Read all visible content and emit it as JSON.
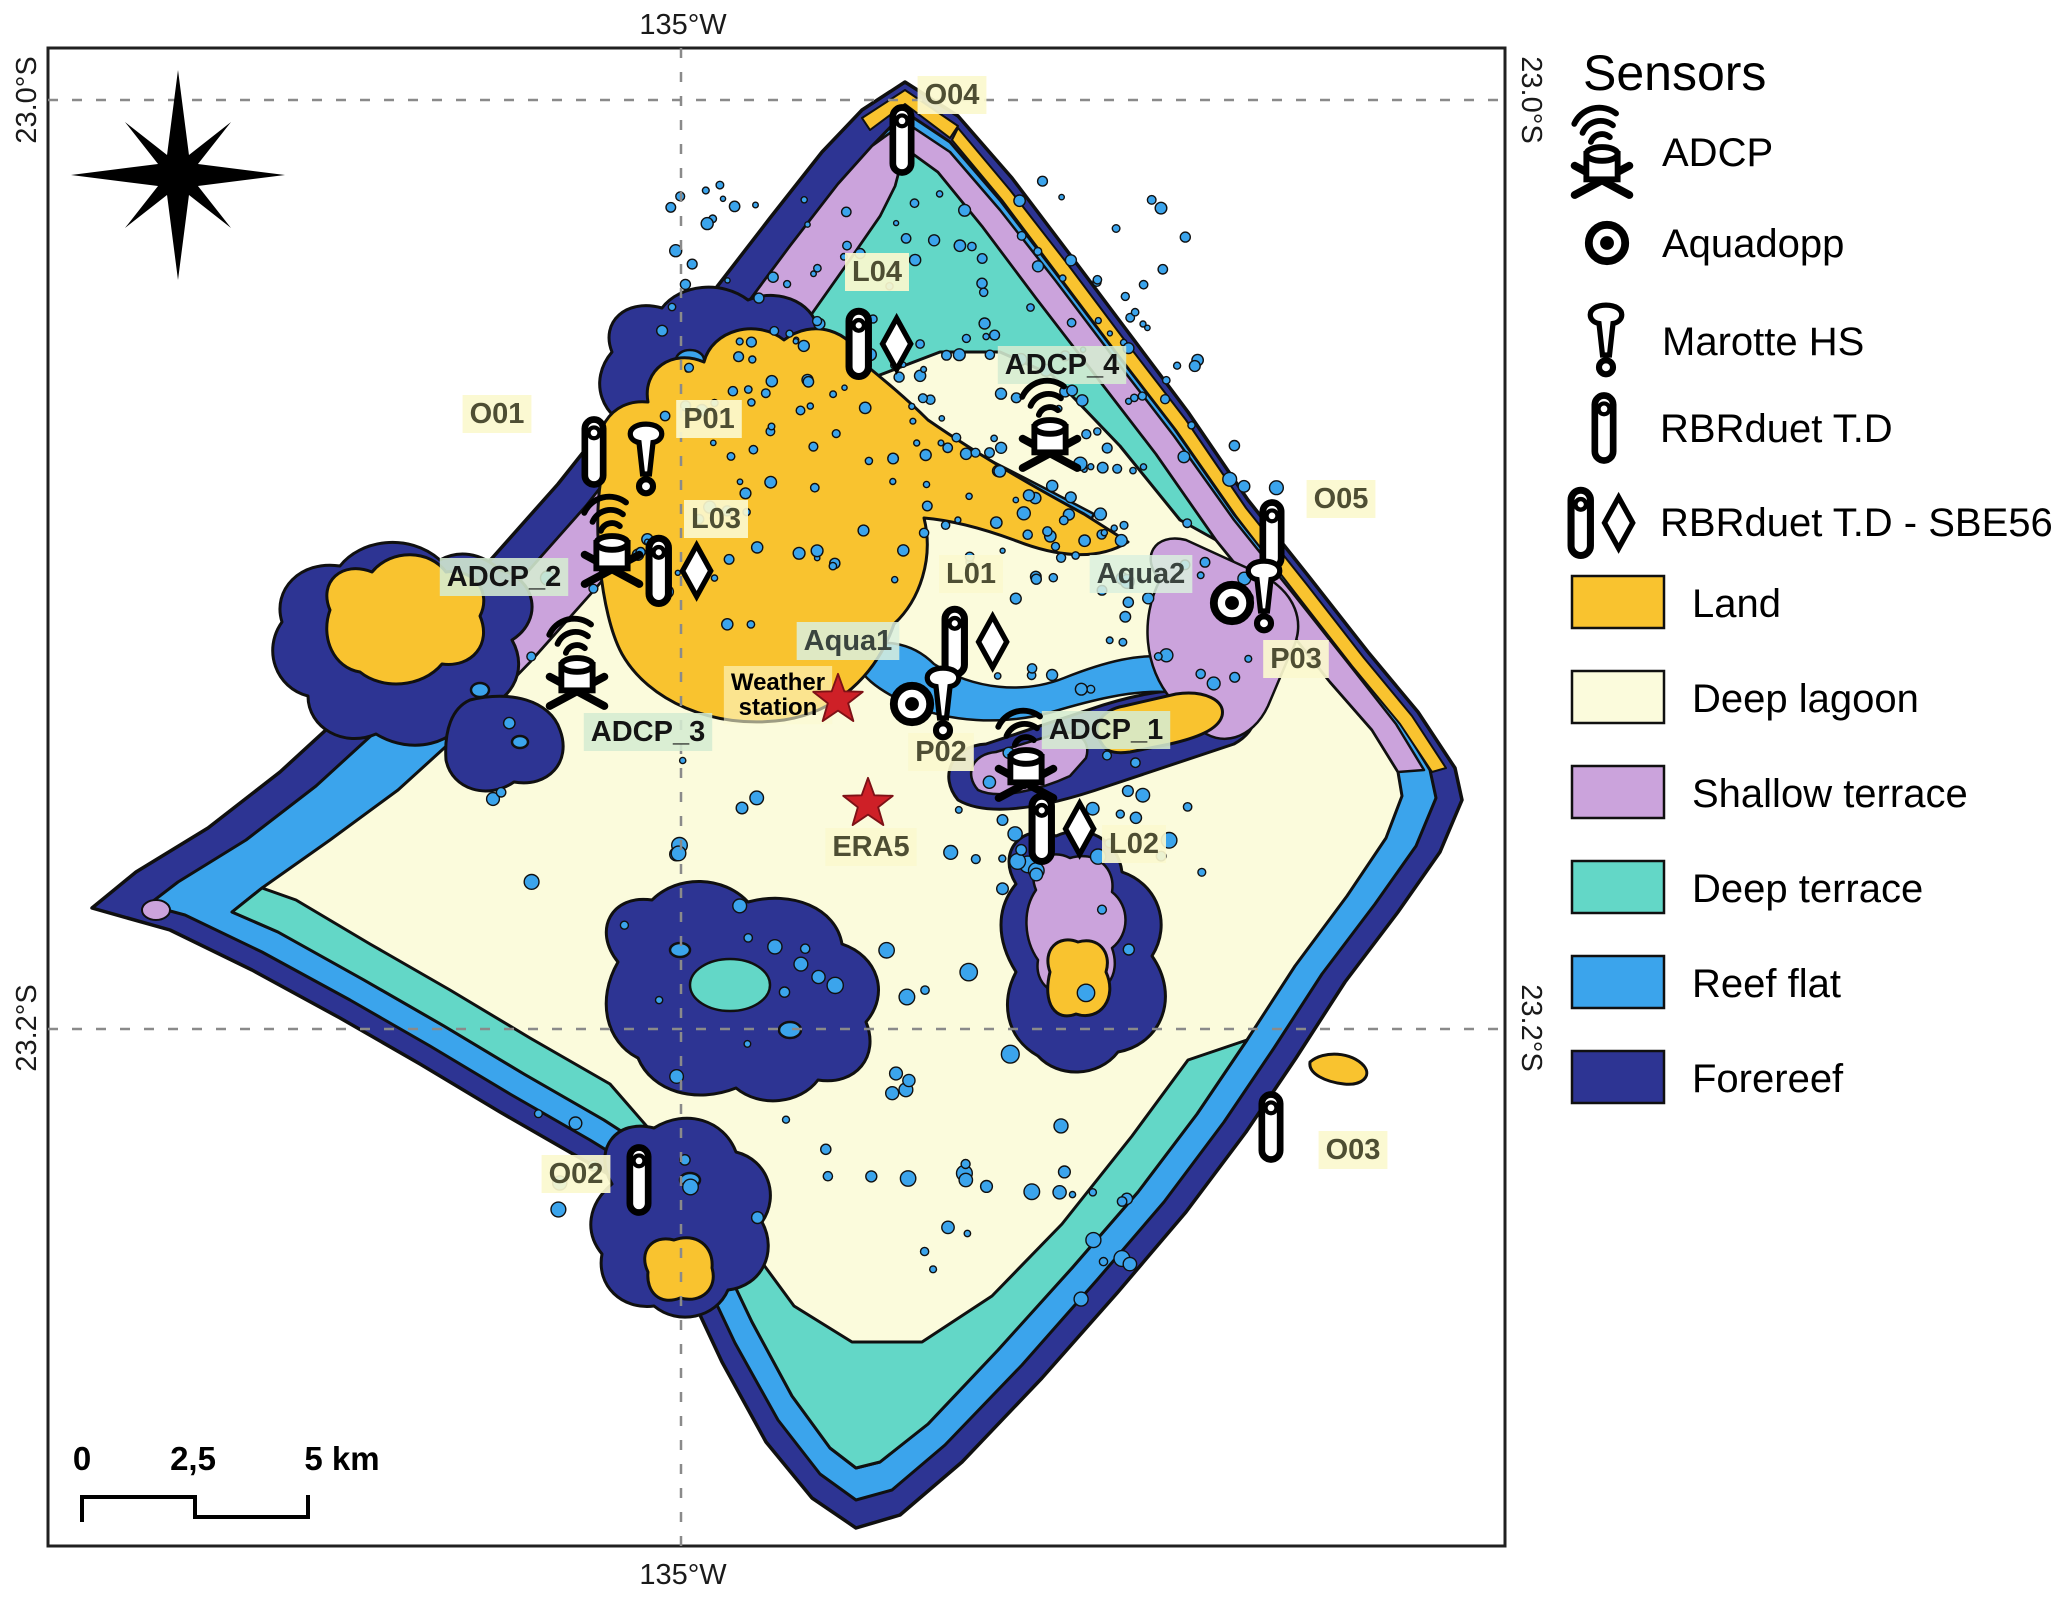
{
  "figure": {
    "axis": {
      "top": "135°W",
      "bottom": "135°W",
      "left_top": "23.0°S",
      "left_bottom": "23.2°S",
      "right_top": "23.0°S",
      "right_bottom": "23.2°S"
    },
    "scale_bar": {
      "ticks": [
        "0",
        "2,5",
        "5 km"
      ]
    }
  },
  "colors": {
    "land": "#F9C32F",
    "deep_lagoon": "#FBFBDC",
    "shallow_terrace": "#CBA3DC",
    "deep_terrace": "#63D7C7",
    "reef_flat": "#3BA4EC",
    "forereef": "#2D3493",
    "outline": "#101010",
    "grid": "#8a8a8a",
    "frame": "#202020",
    "star": "#CE2027"
  },
  "legend": {
    "title": "Sensors",
    "sensors": [
      {
        "icon": "adcp-icon",
        "label": "ADCP"
      },
      {
        "icon": "aquadopp-icon",
        "label": "Aquadopp"
      },
      {
        "icon": "marotte-icon",
        "label": "Marotte HS"
      },
      {
        "icon": "rbr-icon",
        "label": "RBRduet T.D"
      },
      {
        "icon": "rbrsbe-icon",
        "label": "RBRduet T.D - SBE56"
      }
    ],
    "zones": [
      {
        "key": "land",
        "label": "Land"
      },
      {
        "key": "deep_lagoon",
        "label": "Deep lagoon"
      },
      {
        "key": "shallow_terrace",
        "label": "Shallow terrace"
      },
      {
        "key": "deep_terrace",
        "label": "Deep terrace"
      },
      {
        "key": "reef_flat",
        "label": "Reef flat"
      },
      {
        "key": "forereef",
        "label": "Forereef"
      }
    ]
  },
  "map": {
    "label_styles": {
      "yellow": {
        "bg": "rgba(251,249,206,0.92)",
        "fg": "#4E4E33",
        "size": 29
      },
      "green": {
        "bg": "rgba(213,236,210,0.88)",
        "fg": "#141414",
        "size": 29
      },
      "aqua": {
        "bg": "rgba(218,240,222,0.85)",
        "fg": "#3A443E",
        "size": 29
      },
      "weather": {
        "bg": "rgba(252,250,208,0.60)",
        "fg": "#000000",
        "size": 24
      }
    },
    "stations": [
      {
        "id": "O04",
        "label": "O04",
        "lx": 952,
        "ly": 104,
        "style": "yellow",
        "icons": [
          {
            "t": "rbr",
            "x": 902,
            "y": 140
          }
        ]
      },
      {
        "id": "L04",
        "label": "L04",
        "lx": 877,
        "ly": 281,
        "style": "yellow",
        "icons": [
          {
            "t": "rbrsbe",
            "x": 872,
            "y": 343
          }
        ]
      },
      {
        "id": "ADCP_4",
        "label": "ADCP_4",
        "lx": 1062,
        "ly": 374,
        "style": "green",
        "icons": [
          {
            "t": "adcp",
            "x": 1050,
            "y": 442
          }
        ]
      },
      {
        "id": "O01",
        "label": "O01",
        "lx": 497,
        "ly": 423,
        "style": "yellow",
        "icons": [
          {
            "t": "rbr",
            "x": 594,
            "y": 452
          },
          {
            "t": "marotte",
            "x": 646,
            "y": 462
          }
        ]
      },
      {
        "id": "P01",
        "label": "P01",
        "lx": 709,
        "ly": 428,
        "style": "yellow",
        "icons": []
      },
      {
        "id": "L03",
        "label": "L03",
        "lx": 716,
        "ly": 528,
        "style": "yellow",
        "icons": [
          {
            "t": "rbrsbe",
            "x": 672,
            "y": 570
          }
        ]
      },
      {
        "id": "ADCP_2",
        "label": "ADCP_2",
        "lx": 504,
        "ly": 586,
        "style": "green",
        "icons": [
          {
            "t": "adcp",
            "x": 612,
            "y": 558
          }
        ]
      },
      {
        "id": "O05",
        "label": "O05",
        "lx": 1341,
        "ly": 508,
        "style": "yellow",
        "icons": [
          {
            "t": "rbr",
            "x": 1272,
            "y": 535
          }
        ]
      },
      {
        "id": "Aqua2",
        "label": "Aqua2",
        "lx": 1141,
        "ly": 583,
        "style": "aqua",
        "icons": [
          {
            "t": "aquadopp",
            "x": 1232,
            "y": 603
          },
          {
            "t": "marotte",
            "x": 1264,
            "y": 599
          }
        ]
      },
      {
        "id": "P03",
        "label": "P03",
        "lx": 1296,
        "ly": 668,
        "style": "yellow",
        "icons": []
      },
      {
        "id": "L01",
        "label": "L01",
        "lx": 971,
        "ly": 583,
        "style": "yellow",
        "icons": [
          {
            "t": "rbrsbe",
            "x": 968,
            "y": 641
          }
        ]
      },
      {
        "id": "Aqua1",
        "label": "Aqua1",
        "lx": 848,
        "ly": 650,
        "style": "aqua",
        "icons": []
      },
      {
        "id": "Weather",
        "label": "Weather\nstation",
        "lx": 778,
        "ly": 690,
        "style": "weather",
        "icons": [
          {
            "t": "star",
            "x": 838,
            "y": 699
          }
        ]
      },
      {
        "id": "ADCP_3",
        "label": "ADCP_3",
        "lx": 648,
        "ly": 741,
        "style": "green",
        "icons": [
          {
            "t": "adcp",
            "x": 577,
            "y": 680
          }
        ]
      },
      {
        "id": "P02",
        "label": "P02",
        "lx": 941,
        "ly": 761,
        "style": "yellow",
        "icons": [
          {
            "t": "aquadopp",
            "x": 912,
            "y": 704
          },
          {
            "t": "marotte",
            "x": 943,
            "y": 706
          }
        ]
      },
      {
        "id": "ERA5",
        "label": "ERA5",
        "lx": 871,
        "ly": 856,
        "style": "yellow",
        "icons": [
          {
            "t": "star",
            "x": 868,
            "y": 803
          }
        ]
      },
      {
        "id": "ADCP_1",
        "label": "ADCP_1",
        "lx": 1106,
        "ly": 739,
        "style": "green",
        "icons": [
          {
            "t": "adcp",
            "x": 1026,
            "y": 772
          }
        ]
      },
      {
        "id": "L02",
        "label": "L02",
        "lx": 1134,
        "ly": 853,
        "style": "yellow",
        "icons": [
          {
            "t": "rbrsbe",
            "x": 1055,
            "y": 828
          }
        ]
      },
      {
        "id": "O02",
        "label": "O02",
        "lx": 576,
        "ly": 1183,
        "style": "yellow",
        "icons": [
          {
            "t": "rbr",
            "x": 639,
            "y": 1180
          }
        ]
      },
      {
        "id": "O03",
        "label": "O03",
        "lx": 1353,
        "ly": 1159,
        "style": "yellow",
        "icons": [
          {
            "t": "rbr",
            "x": 1271,
            "y": 1127
          }
        ]
      }
    ]
  }
}
